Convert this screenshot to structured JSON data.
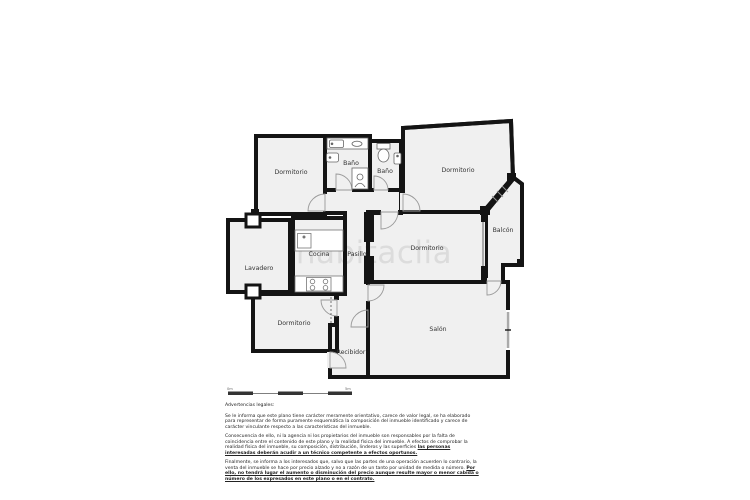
{
  "watermark": "habitaclia",
  "plan": {
    "rooms": {
      "dormitorio_tl": "Dormitorio",
      "bano_1": "Baño",
      "bano_2": "Baño",
      "dormitorio_tr": "Dormitorio",
      "balcon": "Balcón",
      "lavadero": "Lavadero",
      "cocina": "Cocina",
      "pasillo": "Pasillo",
      "dormitorio_centro": "Dormitorio",
      "salon": "Salón",
      "dormitorio_bl": "Dormitorio",
      "recibidor": "Recibidor"
    },
    "scale_bar": {
      "start_label": "0m",
      "end_label": "5m"
    }
  },
  "legal": {
    "title": "Advertencias legales:",
    "p1": "Se le informa que este plano tiene carácter meramente orientativo, carece de valor legal, se ha elaborado para representar de forma puramente esquemática la composición del inmueble identificado y carece de carácter vinculante respecto a las características del inmueble.",
    "p2_normal": "Consecuencia de ello, ni la agencia ni los propietarios del inmueble son responsables por la falta de coincidencia entre el contenido de este plano y la realidad física del inmueble. A efectos de comprobar la realidad física del inmueble, su composición, distribución, linderos y las superficies ",
    "p2_emphasis": "las personas interesadas deberán acudir a un técnico competente a efectos oportunos.",
    "p3_normal": "Finalmente, se informa a los interesados que, salvo que las partes de una operación acuerden lo contrario, la venta del inmueble se hace por precio alzado y no a razón de un tanto por unidad de medida o número. ",
    "p3_emphasis": "Por ello, no tendrá lugar el aumento o disminución del precio aunque resulte mayor o menor cabida o número de los expresados en este plano o en el contrato."
  },
  "colors": {
    "wall": "#141414",
    "room_fill": "#f0f0f0",
    "watermark": "#dcdcdc",
    "door_arc": "#999999",
    "window": "#aaaaaa"
  }
}
